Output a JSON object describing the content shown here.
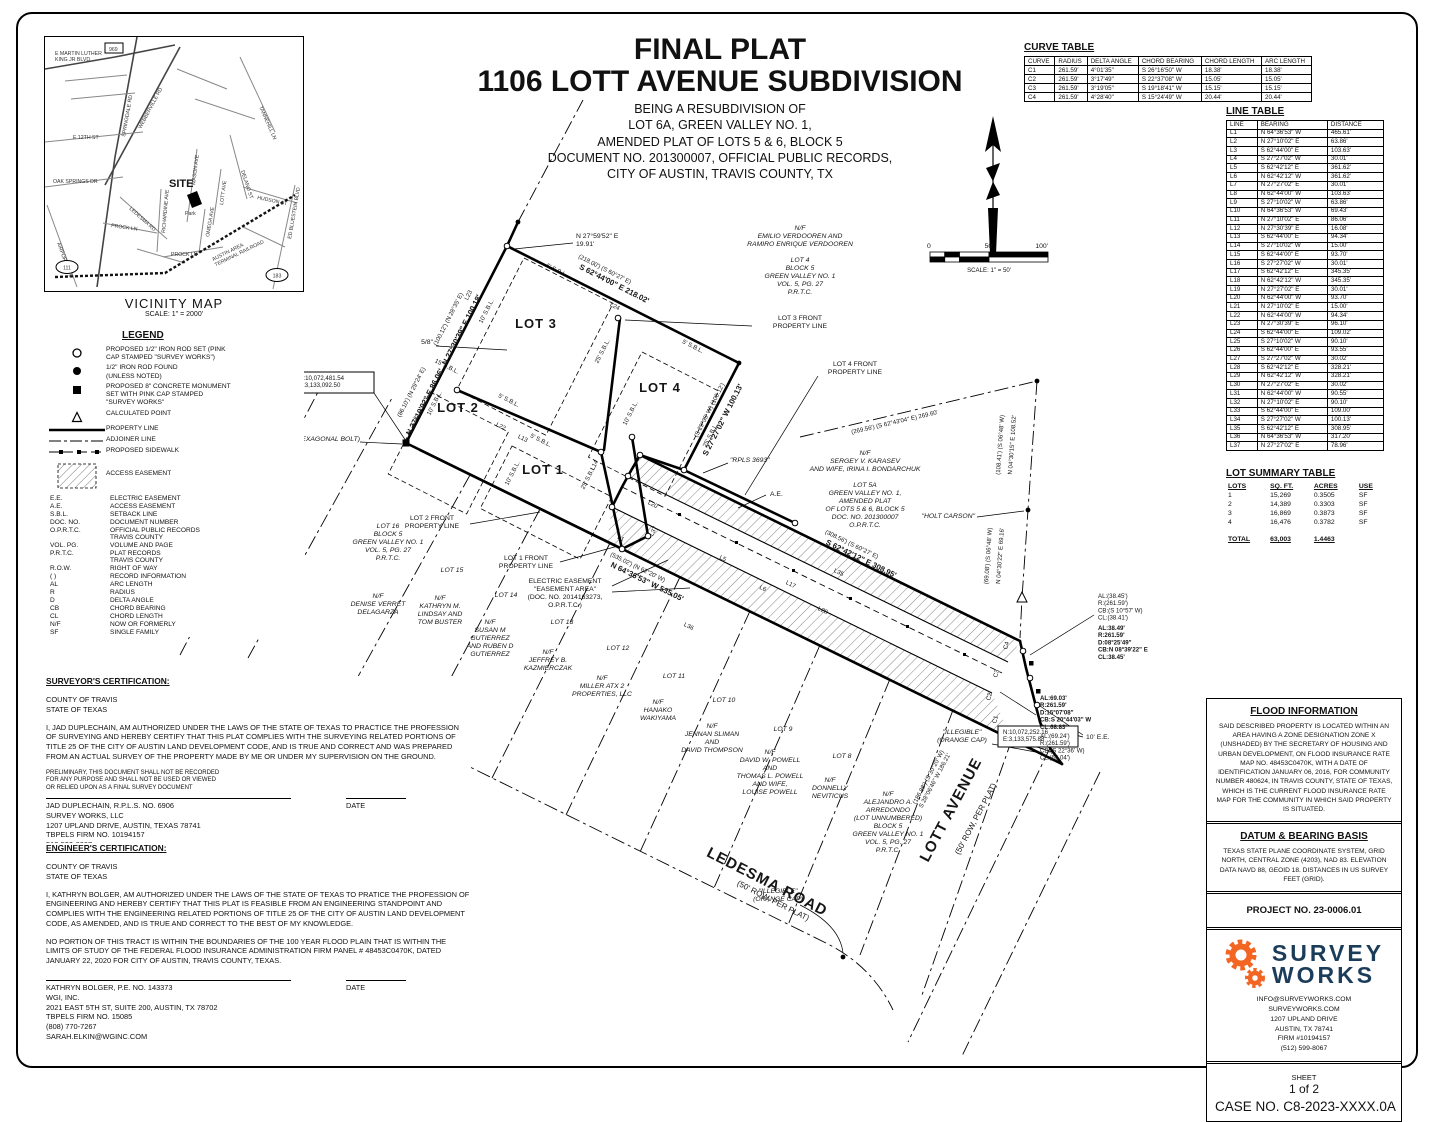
{
  "title": {
    "line1": "FINAL PLAT",
    "line2": "1106 LOTT AVENUE SUBDIVISION",
    "sub": "BEING A RESUBDIVISION OF\nLOT 6A, GREEN VALLEY NO. 1,\nAMENDED PLAT OF LOTS 5 & 6, BLOCK 5\nDOCUMENT NO. 201300007, OFFICIAL PUBLIC RECORDS,\nCITY OF AUSTIN, TRAVIS COUNTY, TX"
  },
  "curve_table": {
    "title": "CURVE TABLE",
    "headers": [
      "CURVE",
      "RADIUS",
      "DELTA ANGLE",
      "CHORD BEARING",
      "CHORD LENGTH",
      "ARC LENGTH"
    ],
    "rows": [
      [
        "C1",
        "261.59'",
        "4°01'35\"",
        "S 26°16'50\" W",
        "18.38'",
        "18.38'"
      ],
      [
        "C2",
        "261.59'",
        "3°17'49\"",
        "S 22°37'08\" W",
        "15.05'",
        "15.05'"
      ],
      [
        "C3",
        "261.59'",
        "3°19'05\"",
        "S 19°18'41\" W",
        "15.15'",
        "15.15'"
      ],
      [
        "C4",
        "261.59'",
        "4°28'40\"",
        "S 15°24'49\" W",
        "20.44'",
        "20.44'"
      ]
    ]
  },
  "line_table": {
    "title": "LINE TABLE",
    "headers": [
      "LINE",
      "BEARING",
      "DISTANCE"
    ],
    "rows": [
      [
        "L1",
        "N 64°36'53\" W",
        "465.61'"
      ],
      [
        "L2",
        "N 27°10'02\" E",
        "63.86'"
      ],
      [
        "L3",
        "S 62°44'00\" E",
        "103.63'"
      ],
      [
        "L4",
        "S 27°27'02\" W",
        "30.01'"
      ],
      [
        "L5",
        "S 62°42'12\" E",
        "361.62'"
      ],
      [
        "L6",
        "N 62°42'12\" W",
        "361.62'"
      ],
      [
        "L7",
        "N 27°27'02\" E",
        "30.01'"
      ],
      [
        "L8",
        "N 62°44'00\" W",
        "103.63'"
      ],
      [
        "L9",
        "S 27°10'02\" W",
        "63.86'"
      ],
      [
        "L10",
        "N 64°36'53\" W",
        "69.43'"
      ],
      [
        "L11",
        "N 27°10'02\" E",
        "86.06'"
      ],
      [
        "L12",
        "N 27°30'39\" E",
        "16.08'"
      ],
      [
        "L13",
        "S 62°44'00\" E",
        "94.34'"
      ],
      [
        "L14",
        "S 27°10'02\" W",
        "15.00'"
      ],
      [
        "L15",
        "S 62°44'00\" E",
        "93.70'"
      ],
      [
        "L16",
        "S 27°27'02\" W",
        "30.01'"
      ],
      [
        "L17",
        "S 62°42'12\" E",
        "345.35'"
      ],
      [
        "L18",
        "N 62°42'12\" W",
        "345.35'"
      ],
      [
        "L19",
        "N 27°27'02\" E",
        "30.01'"
      ],
      [
        "L20",
        "N 62°44'00\" W",
        "93.70'"
      ],
      [
        "L21",
        "N 27°10'02\" E",
        "15.00'"
      ],
      [
        "L22",
        "N 62°44'00\" W",
        "94.34'"
      ],
      [
        "L23",
        "N 27°30'39\" E",
        "96.10'"
      ],
      [
        "L24",
        "S 62°44'00\" E",
        "109.02'"
      ],
      [
        "L25",
        "S 27°10'02\" W",
        "90.10'"
      ],
      [
        "L26",
        "S 62°44'00\" E",
        "93.55'"
      ],
      [
        "L27",
        "S 27°27'02\" W",
        "30.02'"
      ],
      [
        "L28",
        "S 62°42'12\" E",
        "328.21'"
      ],
      [
        "L29",
        "N 62°42'12\" W",
        "328.21'"
      ],
      [
        "L30",
        "N 27°27'02\" E",
        "30.02'"
      ],
      [
        "L31",
        "N 62°44'00\" W",
        "90.55'"
      ],
      [
        "L32",
        "N 27°10'02\" E",
        "90.10'"
      ],
      [
        "L33",
        "S 62°44'00\" E",
        "109.00'"
      ],
      [
        "L34",
        "S 27°27'02\" W",
        "100.13'"
      ],
      [
        "L35",
        "S 62°42'12\" E",
        "308.95'"
      ],
      [
        "L36",
        "N 64°36'53\" W",
        "317.20'"
      ],
      [
        "L37",
        "N 27°27'02\" E",
        "78.96'"
      ]
    ]
  },
  "lot_summary": {
    "title": "LOT SUMMARY TABLE",
    "headers": [
      "LOTS",
      "SQ. FT.",
      "ACRES",
      "USE"
    ],
    "rows": [
      [
        "1",
        "15,269",
        "0.3505",
        "SF"
      ],
      [
        "2",
        "14,389",
        "0.3303",
        "SF"
      ],
      [
        "3",
        "16,869",
        "0.3873",
        "SF"
      ],
      [
        "4",
        "16,476",
        "0.3782",
        "SF"
      ]
    ],
    "total": [
      "TOTAL",
      "63,003",
      "1.4463",
      ""
    ]
  },
  "legend": {
    "heading": "LEGEND",
    "s1": "PROPOSED 1/2\" IRON ROD SET (PINK\nCAP STAMPED \"SURVEY WORKS\")",
    "s2": "1/2\" IRON ROD FOUND\n(UNLESS NOTED)",
    "s3": "PROPOSED 8\" CONCRETE MONUMENT\nSET WITH PINK CAP STAMPED\n\"SURVEY WORKS\"",
    "s4": "CALCULATED POINT",
    "s5": "PROPERTY LINE",
    "s6": "ADJOINER LINE",
    "s7": "PROPOSED SIDEWALK",
    "s8": "ACCESS EASEMENT",
    "abbr": {
      "headers": [],
      "rows": [
        [
          "E.E.",
          "ELECTRIC EASEMENT"
        ],
        [
          "A.E.",
          "ACCESS EASEMENT"
        ],
        [
          "S.B.L.",
          "SETBACK LINE"
        ],
        [
          "DOC. NO.",
          "DOCUMENT NUMBER"
        ],
        [
          "O.P.R.T.C.",
          "OFFICIAL PUBLIC RECORDS\nTRAVIS COUNTY"
        ],
        [
          "VOL. PG.",
          "VOLUME AND PAGE"
        ],
        [
          "P.R.T.C.",
          "PLAT RECORDS\nTRAVIS COUNTY"
        ],
        [
          "R.O.W.",
          "RIGHT OF WAY"
        ],
        [
          "(    )",
          "RECORD INFORMATION"
        ],
        [
          "AL",
          "ARC LENGTH"
        ],
        [
          "R",
          "RADIUS"
        ],
        [
          "D",
          "DELTA ANGLE"
        ],
        [
          "CB",
          "CHORD BEARING"
        ],
        [
          "CL",
          "CHORD LENGTH"
        ],
        [
          "N/F",
          "NOW OR FORMERLY"
        ],
        [
          "SF",
          "SINGLE FAMILY"
        ]
      ]
    }
  },
  "vicinity": {
    "caption": "VICINITY MAP",
    "scale": "SCALE: 1\" = 2000'",
    "site": "SITE",
    "park": "Park",
    "streets": {
      "mlk": "E MARTIN LUTHER\nKING JR BLVD",
      "springdale": "SPRINGDALE RD",
      "webberville": "WEBBERVILLE RD",
      "e12": "E 12TH ST",
      "tannehill": "TANNEHILL LN",
      "oaksprings": "OAK SPRINGS DR",
      "ledesma": "LEDESMA RD",
      "mason": "MASON AVE",
      "delano": "DELANO ST",
      "lott": "LOTT AVE",
      "hudson": "HUDSON ST",
      "prock": "PROCK LN",
      "richardine": "RICHARDINE AVE",
      "omega": "OMEGA AVE",
      "prock2": "PROCK LN",
      "airport": "AIRPORT BLVD",
      "railroad": "AUSTIN AREA\nTERMINAL RAILROAD",
      "bluestein": "ED BLUESTEIN BLVD"
    },
    "shields": {
      "sh969": "969",
      "sh111": "111",
      "sh183": "183"
    }
  },
  "north_scale": {
    "n": "N",
    "s0": "0",
    "s50": "50'",
    "s100": "100'",
    "caption": "SCALE: 1\" = 50'"
  },
  "surveyor_cert": {
    "heading": "SURVEYOR'S CERTIFICATION:",
    "loc": "COUNTY OF TRAVIS\nSTATE OF TEXAS",
    "body": "I, JAD DUPLECHAIN, AM AUTHORIZED UNDER THE LAWS OF THE STATE OF TEXAS TO PRACTICE THE PROFESSION OF SURVEYING AND HEREBY CERTIFY THAT THIS PLAT COMPLIES WITH THE SURVEYING RELATED PORTIONS OF TITLE 25 OF THE CITY OF AUSTIN LAND DEVELOPMENT CODE, AND IS TRUE AND CORRECT AND WAS PREPARED FROM AN ACTUAL SURVEY OF THE PROPERTY MADE BY ME OR UNDER MY SUPERVISION ON THE GROUND.",
    "prelim": "PRELIMINARY, THIS DOCUMENT SHALL NOT BE RECORDED\nFOR ANY PURPOSE AND SHALL NOT BE USED OR VIEWED\nOR RELIED UPON AS A FINAL SURVEY DOCUMENT",
    "sig": "JAD DUPLECHAIN, R.P.L.S. NO. 6906\nSURVEY WORKS, LLC\n1207 UPLAND DRIVE, AUSTIN, TEXAS 78741\nTBPELS FIRM NO. 10194157\n512-599-8067\nINFO@SURVEYWORKS.COM",
    "date_label": "DATE"
  },
  "engineer_cert": {
    "heading": "ENGINEER'S CERTIFICATION:",
    "loc": "COUNTY OF TRAVIS\nSTATE OF TEXAS",
    "body1": "I, KATHRYN BOLGER, AM AUTHORIZED UNDER THE LAWS OF THE STATE OF TEXAS TO PRATICE THE PROFESSION OF ENGINEERING AND HEREBY CERTIFY THAT THIS PLAT IS FEASIBLE FROM AN ENGINEERING STANDPOINT AND COMPLIES WITH THE ENGINEERING RELATED PORTIONS OF TITLE 25 OF THE CITY OF AUSTIN LAND DEVELOPMENT CODE, AS AMENDED, AND IS TRUE AND CORRECT TO THE BEST OF MY KNOWLEDGE.",
    "body2": "NO PORTION OF THIS TRACT IS WITHIN THE BOUNDARIES OF THE 100 YEAR FLOOD PLAIN THAT IS WITHIN THE LIMITS OF STUDY OF THE FEDERAL FLOOD INSURANCE ADMINISTRATION FIRM PANEL # 48453C0470K, DATED JANUARY 22, 2020 FOR CITY OF AUSTIN, TRAVIS COUNTY, TEXAS.",
    "sig": "KATHRYN BOLGER, P.E. NO. 143373\nWGI, INC.\n2021 EAST 5TH ST, SUITE 200, AUSTIN, TX 78702\nTBPELS FIRM NO. 15085\n(808) 770-7267\nSARAH.ELKIN@WGINC.COM",
    "date_label": "DATE"
  },
  "flood": {
    "heading": "FLOOD INFORMATION",
    "body": "SAID DESCRIBED PROPERTY IS LOCATED WITHIN AN AREA HAVING A ZONE DESIGNATION ZONE X (UNSHADED) BY THE SECRETARY OF HOUSING AND URBAN DEVELOPMENT, ON FLOOD INSURANCE RATE MAP NO. 48453C0470K, WITH A DATE OF IDENTIFICATION JANUARY 06, 2016, FOR COMMUNITY NUMBER 480624, IN TRAVIS COUNTY, STATE OF TEXAS, WHICH IS THE CURRENT FLOOD INSURANCE RATE MAP FOR THE COMMUNITY IN WHICH SAID PROPERTY IS SITUATED."
  },
  "datum": {
    "heading": "DATUM & BEARING BASIS",
    "body": "TEXAS STATE PLANE COORDINATE SYSTEM, GRID NORTH, CENTRAL ZONE (4203), NAD 83. ELEVATION DATA NAVD 88, GEOID 18. DISTANCES IN US SURVEY FEET (GRID)."
  },
  "project": {
    "label": "PROJECT NO. 23-0006.01"
  },
  "logo": {
    "name1": "SURVEY",
    "name2": "WORKS",
    "contact": "INFO@SURVEYWORKS.COM\nSURVEYWORKS.COM\n1207 UPLAND DRIVE\nAUSTIN, TX 78741\nFIRM #10194157\n(512) 599-8067",
    "orange": "#F26522",
    "navy": "#1C3D5A"
  },
  "sheet": {
    "label": "SHEET",
    "num": "1 of 2",
    "case": "CASE NO. C8-2023-XXXX.0A"
  },
  "plat": {
    "labels": {
      "lot1": "LOT 1",
      "lot2": "LOT 2",
      "lot3": "LOT 3",
      "lot4": "LOT 4",
      "b1": "N 27°59'52\" E\n19.91'",
      "b2": "S 62°44'00\" E  218.02'",
      "b2r": "(218.00') (S 60°27' E)",
      "b3": "N 27°30'39\" E  100.18'",
      "b3r": "(100.12') (N 28°35' E)",
      "b4": "N 27°10'02\" E  86.06'",
      "b4r": "(86.10') (N 29°24' E)",
      "b5": "S 27°27'02\" W  100.13'",
      "b5r": "(S 29°35' W) (100.12')",
      "b6": "S 62°42'12\" E  308.95'",
      "b6r": "(308.56') (S 60°27' E)",
      "b7": "N 64°36'53\" W  535.05'",
      "b7r": "(535.02') (N 62°20' W)",
      "b8": "N 04°30'15\" E  108.52'",
      "b8r": "(108.41') (S 06°48' W)",
      "b9": "N 04°30'22\" E  69.16'",
      "b9r": "(69.08') (S 06°48' W)",
      "b10": "(186.88') (S 30°20' W)\nS 28°06'46\" W  186.21'",
      "b11": "(269.56') (S 62°43'04\" E)  269.60'",
      "front1": "LOT 1 FRONT\nPROPERTY LINE",
      "front2": "LOT 2 FRONT\nPROPERTY LINE",
      "front3": "LOT 3 FRONT\nPROPERTY LINE",
      "front4": "LOT 4 FRONT\nPROPERTY LINE",
      "nf1": "N/F\nEMILIO VERDOOREN AND\nRAMIRO ENRIQUE VERDOOREN\n \nLOT 4\nBLOCK 5\nGREEN VALLEY NO. 1\nVOL. 5, PG. 27\nP.R.T.C.",
      "nf2": "N/F\nSERGEY V. KARASEV\nAND WIFE, IRINA I. BONDARCHUK\n \nLOT 5A\nGREEN VALLEY NO. 1,\nAMENDED PLAT\nOF LOTS 5 & 6, BLOCK 5\nDOC. NO. 201300007\nO.P.R.T.C.",
      "holt": "\"HOLT CARSON\"",
      "rpls": "\"RPLS 3693\"",
      "ee": "ELECTRIC EASEMENT\n\"EASEMENT AREA\"\n(DOC. NO. 2014163273,\nO.P.R.T.C.)",
      "ae": "A.E.",
      "tenee": "10' E.E.",
      "called": "CALLED 0.496 ACRES\n(TRACT 2)\nDOC. NO. 2011063166\nO.P.R.T.C.",
      "nfdela": "N/F\nDENISE VERRET\nDELAGARZA",
      "lot16": "LOT 16\nBLOCK 5\nGREEN VALLEY NO. 1\nVOL. 5, PG. 27\nP.R.T.C.",
      "lot15": "LOT 15",
      "nf15": "N/F\nKATHRYN M.\nLINDSAY AND\nTOM BUSTER",
      "lot14": "LOT 14",
      "nf14": "N/F\nSUSAN M\nGUTIERREZ\nAND RUBEN D\nGUTIERREZ",
      "lot13": "LOT 13",
      "nf13": "N/F\nJEFFREY B.\nKAZMIERCZAK",
      "lot12": "LOT 12",
      "nf12": "N/F\nMILLER ATX 2\nPROPERTIES, LLC",
      "lot11": "LOT 11",
      "nf11": "N/F\nHANAKO\nWAKIYAMA",
      "lot10": "LOT 10",
      "nf10": "N/F\nJENNAN SLIMAN\nAND\nDAVID THOMPSON",
      "lot9": "LOT 9",
      "nf9": "N/F\nDAVID W. POWELL\nAND\nTHOMAS L. POWELL\nAND WIFE,\nLOUISE POWELL",
      "lot8": "LOT 8",
      "nf8": "N/F\nDONNELLY\nNEVITICUS",
      "nfarr": "N/F\nALEJANDRO A.\nARREDONDO\n(LOT UNNUMBERED)\nBLOCK 5\nGREEN VALLEY NO. 1\nVOL. 5, PG. 27\nP.R.T.C.",
      "illeg": "\"ILLEGIBLE\"\n(ORANGE CAP)",
      "ledesma": "LEDESMA ROAD",
      "ledesma2": "(50' ROW, PER PLAT)",
      "lott": "LOTT AVENUE",
      "lott2": "(50' ROW, PER PLAT)",
      "coord1": "N:10,072,481.54\nE:3,133,092.50",
      "coord2": "N:10,072,252.16\nE:3,133,575.88",
      "hex": "(HEXAGONAL BOLT)",
      "fe": "5/8\"",
      "stack1": "AL:(38.45')\nR:(261.59')\nCB:(S 10°57' W)\nCL:(38.41')",
      "stack1b": "AL:38.49'\nR:261.59'\nD:08°25'49\"\nCB:N 08°39'22\" E\nCL:38.45'",
      "stack2": "AL:69.03'\nR:261.59'\nD:15°07'08\"\nCB:S 20°44'03\" W\nCL:68.83'",
      "stack2b": "AL:(69.24')\nR:(261.59')\nCB:(S 22°36' W)\nCL:(69.04')",
      "s5": "5' S.B.L.",
      "s10": "10' S.B.L.",
      "s15": "15' S.B.L.",
      "s25": "25' S.B.L.",
      "l1": "L1",
      "l5": "L5",
      "l6": "L6",
      "l13": "L13",
      "l14": "L14",
      "l17": "L17",
      "l20": "L20",
      "l22": "L22",
      "l23": "L23",
      "l24": "L24",
      "l28": "L28",
      "l35": "L35",
      "l36": "L36",
      "l37": "L37",
      "c1": "C1",
      "c2": "C2",
      "c3": "C3",
      "c4": "C4"
    }
  }
}
